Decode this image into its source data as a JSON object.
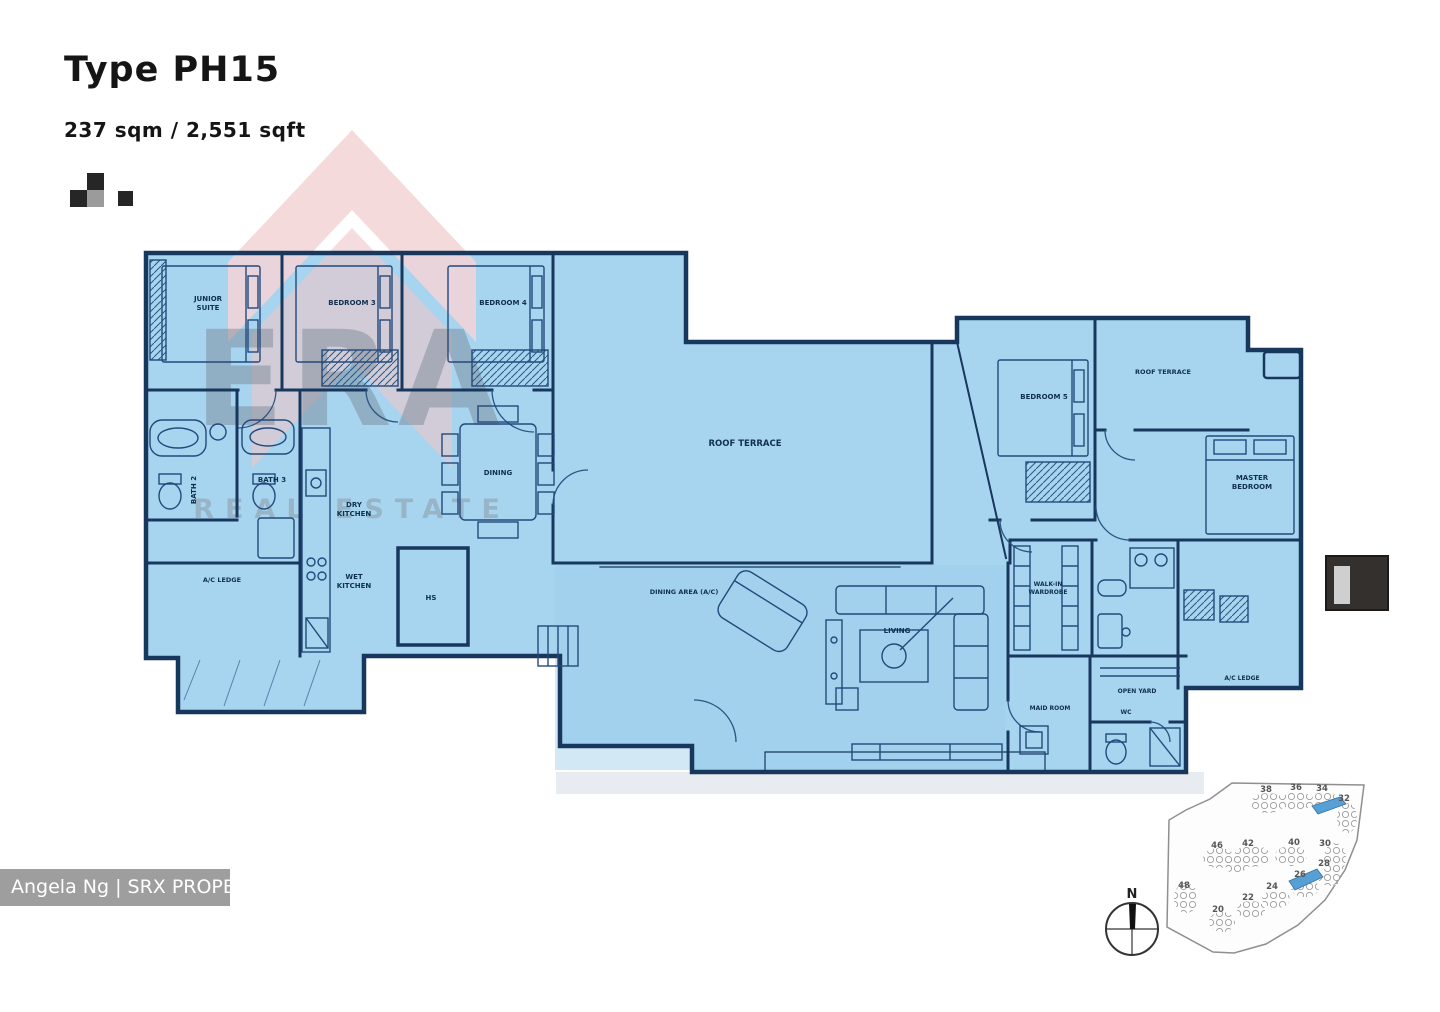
{
  "header": {
    "title": "Type PH15",
    "area": "237 sqm / 2,551 sqft"
  },
  "watermark": {
    "era": "ERA",
    "era_sub": "REAL ESTATE",
    "agent": "Angela Ng | SRX PROPERTY"
  },
  "rooms": {
    "junior_suite_l1": "JUNIOR",
    "junior_suite_l2": "SUITE",
    "bedroom3": "BEDROOM 3",
    "bedroom4": "BEDROOM 4",
    "bath2": "BATH 2",
    "bath3": "BATH 3",
    "dry_kitchen_l1": "DRY",
    "dry_kitchen_l2": "KITCHEN",
    "wet_kitchen_l1": "WET",
    "wet_kitchen_l2": "KITCHEN",
    "hs": "HS",
    "ac_ledge_left": "A/C LEDGE",
    "dining": "DINING",
    "roof_terrace_main": "ROOF TERRACE",
    "dining_area": "DINING AREA (A/C)",
    "living": "LIVING",
    "bedroom5": "BEDROOM 5",
    "roof_terrace_right": "ROOF TERRACE",
    "master_l1": "MASTER",
    "master_l2": "BEDROOM",
    "wiw_l1": "WALK-IN",
    "wiw_l2": "WARDROBE",
    "open_yard": "OPEN YARD",
    "maid_room": "MAID ROOM",
    "wc": "WC",
    "ac_ledge_right": "A/C LEDGE"
  },
  "compass": {
    "north": "N"
  },
  "siteplan": {
    "blocks": [
      "38",
      "36",
      "34",
      "32",
      "46",
      "42",
      "40",
      "30",
      "48",
      "28",
      "26",
      "24",
      "22",
      "20"
    ]
  }
}
